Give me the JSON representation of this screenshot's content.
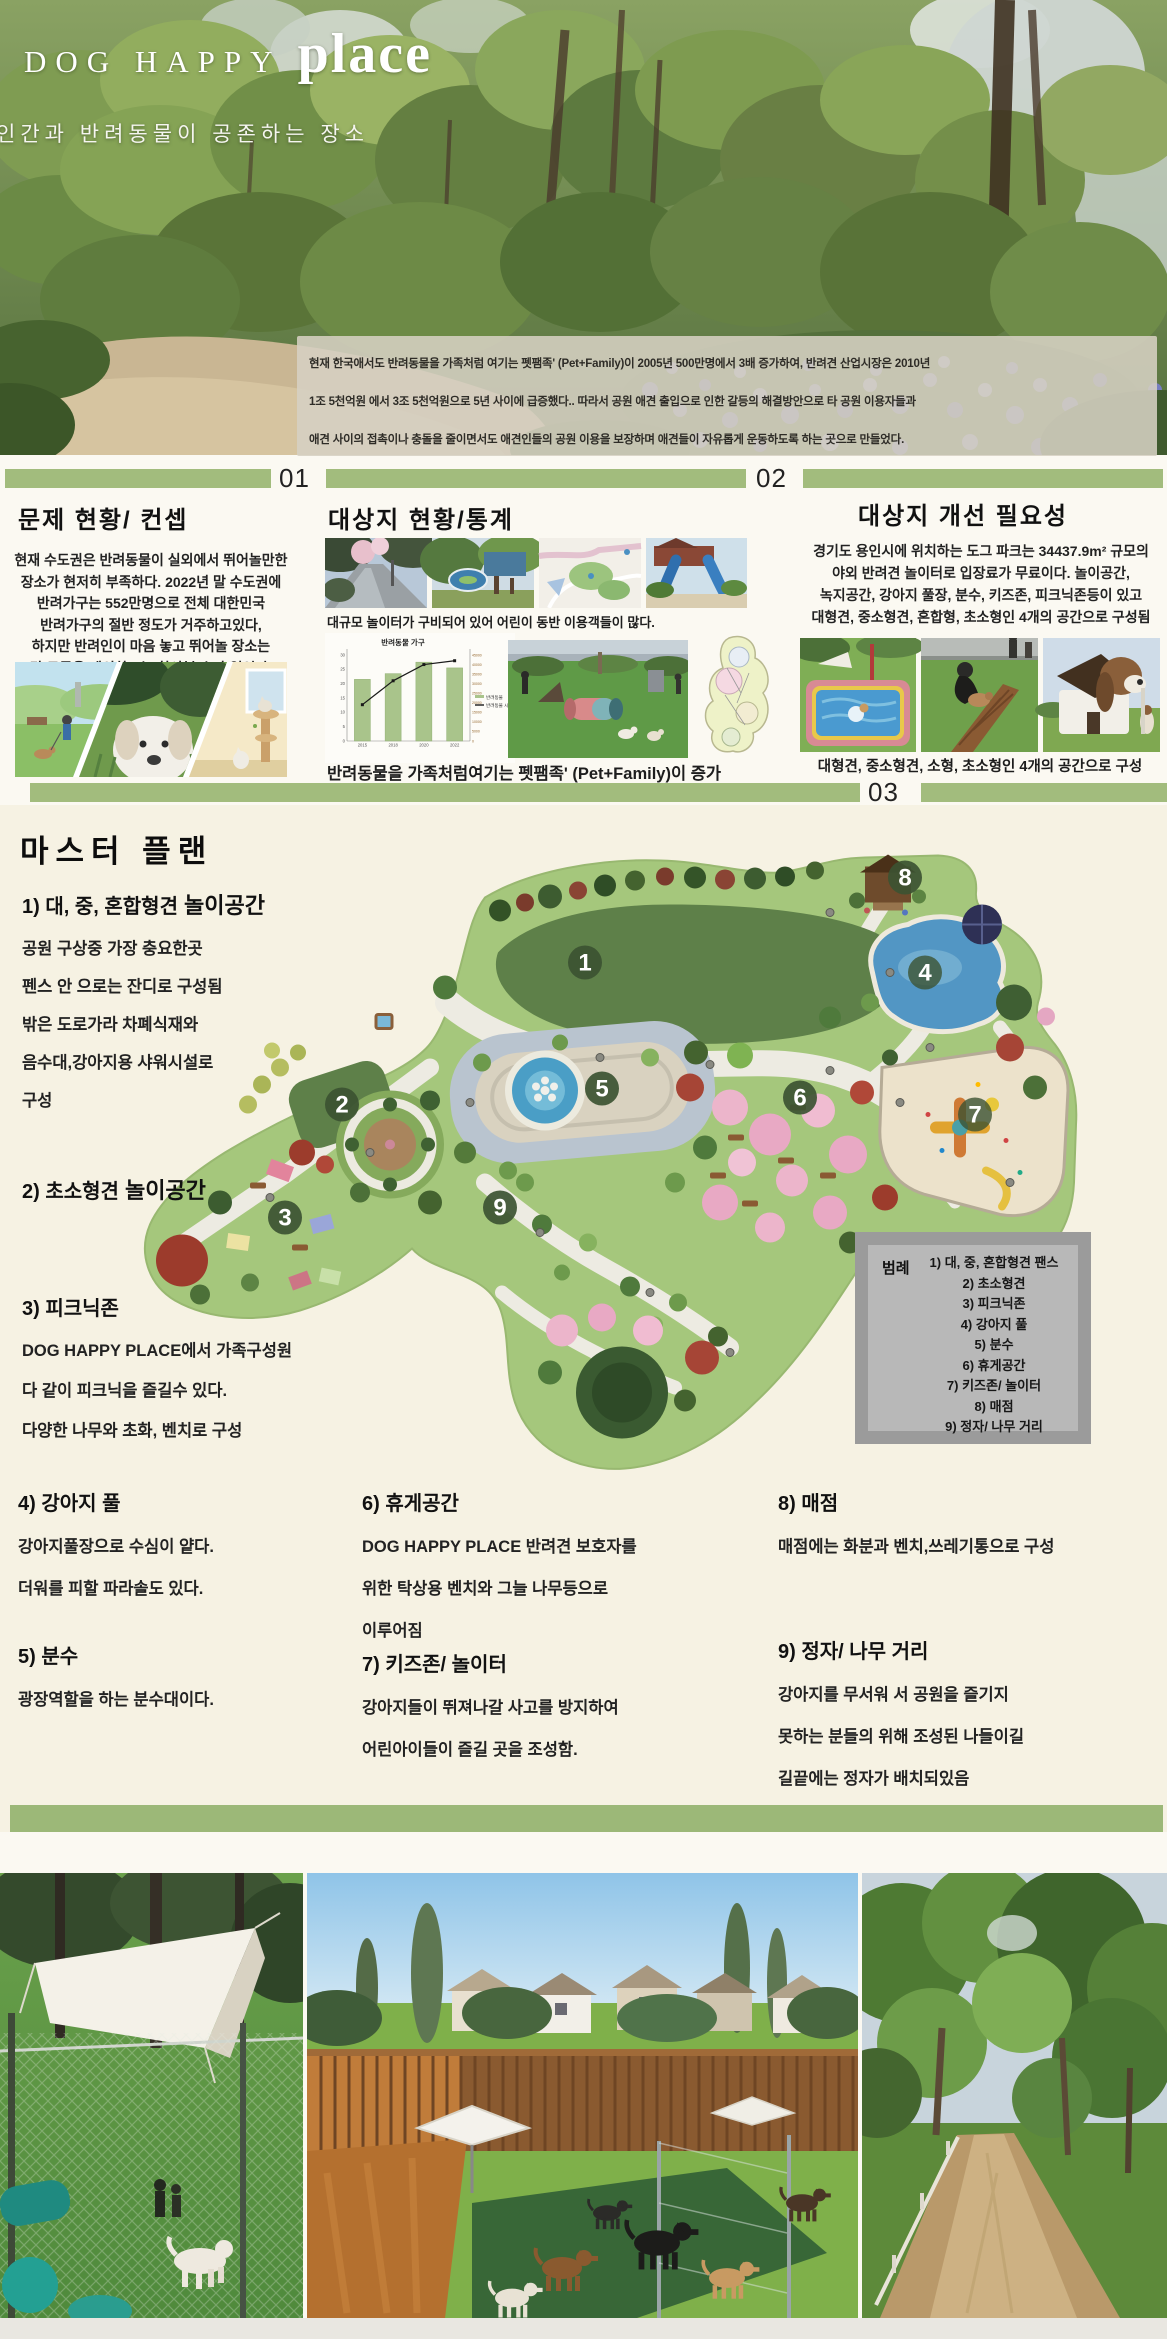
{
  "header": {
    "title_main": "DOG HAPPY",
    "title_accent": "place",
    "subtitle": "인간과 반려동물이 공존하는 장소",
    "intro": "현재 한국애서도 반려동물을 가족처럼 여기는 펫팸족' (Pet+Family)이 2005년 500만명에서 3배 증가하여, 반려견 산업시장은 2010년\n1조 5천억원 에서 3조 5천억원으로 5년 사이에 급증했다.. 따라서 공원 애견 출입으로 인한 갈등의 해결방안으로 타 공원 이용자들과\n애견 사이의 접촉이나 충돌을 줄이면서도 애견인들의 공원 이용을 보장하며 애견들이 자유롭게 운동하도록 하는 곳으로 만들었다."
  },
  "dividers": {
    "n1": "01",
    "n2": "02",
    "n3": "03"
  },
  "columns": {
    "problem": {
      "title": "문제 현황/ 컨셉",
      "body": "현재 수도권은 반려동물이 실외에서 뛰어놀만한\n장소가 현저히 부족하다. 2022년 말 수도권에\n반려가구는 552만명으로 전체 대한민국\n반려가구의 절반 정도가 거주하고있다,\n하지만 반려인이 마음 놓고 뛰어놀 장소는\n단 두곳을 제외하고는 찾아볼 수가 없었다."
    },
    "site": {
      "title": "대상지 현황/통계",
      "caption_top": "대규모 놀이터가 구비되어 있어 어린이 동반 이용객들이 많다.",
      "caption_bottom": "반려동물을 가족처럼여기는 펫팸족' (Pet+Family)이 증가"
    },
    "need": {
      "title": "대상지 개선 필요성",
      "body": "경기도 용인시에 위치하는 도그 파크는 34437.9m² 규모의\n야외 반려견 놀이터로 입장료가 무료이다. 놀이공간,\n녹지공간, 강아지 풀장, 분수, 키즈존, 피크닉존등이 있고\n대형견, 중소형견, 혼합형, 초소형인 4개의 공간으로 구성됨",
      "caption": "대형견, 중소형견, 소형, 초소형인 4개의 공간으로 구성"
    }
  },
  "chart_data": {
    "type": "bar+line",
    "title": "반려동물 가구",
    "categories": [
      "2015",
      "2018",
      "2020",
      "2022"
    ],
    "series": [
      {
        "name": "반려동물",
        "type": "bar",
        "axis": "left",
        "values": [
          21.5,
          23.5,
          27.5,
          25.5
        ]
      },
      {
        "name": "반려동물 시장",
        "type": "line",
        "axis": "right",
        "values": [
          19000,
          31500,
          40000,
          42000
        ]
      }
    ],
    "left_axis_max": 30,
    "left_axis_step": 5,
    "right_axis_max": 45000,
    "right_axis_step": 5000,
    "legend_position": "right",
    "bar_color": "#a9c48b",
    "line_color": "#1a1a1a"
  },
  "master": {
    "title": "마스터 플랜",
    "items": [
      {
        "heading": "1) 대, 중, 혼합형견",
        "heading_bold": "놀이공간",
        "body": "공원 구상중 가장 충요한곳\n펜스 안 으로는 잔디로 구성됨\n밖은 도로가라 차폐식재와\n음수대,강아지용 샤워시설로\n구성"
      },
      {
        "heading": "2) 초소형견",
        "heading_bold": "놀이공간",
        "body": ""
      },
      {
        "heading": "3) 피크닉존",
        "body": "DOG HAPPY PLACE에서 가족구성원\n다 같이 피크닉을 즐길수 있다.\n다양한 나무와 초화, 벤치로 구성"
      },
      {
        "heading": "4) 강아지 풀",
        "body": "강아지풀장으로 수심이 얕다.\n더워를 피할 파라솔도 있다."
      },
      {
        "heading": "5) 분수",
        "body": "광장역할을 하는 분수대이다."
      },
      {
        "heading": "6) 휴게공간",
        "body": "DOG HAPPY PLACE 반려견 보호자를\n위한 탁상용 벤치와 그늘 나무등으로\n이루어짐"
      },
      {
        "heading": "7) 키즈존/ 놀이터",
        "body": "강아지들이 뛰져나갈 사고를 방지하여\n어린아이들이 즐길 곳을 조성함."
      },
      {
        "heading": "8) 매점",
        "body": "매점에는 화분과 벤치,쓰레기통으로 구성"
      },
      {
        "heading": "9) 정자/ 나무 거리",
        "body": "강아지를 무서워 서 공원을 즐기지\n못하는 분들의 위해 조성된 나들이길\n길끝에는 정자가 배치되있음"
      }
    ],
    "legend": {
      "label": "범례",
      "items": [
        "1) 대, 중, 혼합형견 팬스",
        "2) 초소형견",
        "3) 피크닉존",
        "4) 강아지 풀",
        "5) 분수",
        "6) 휴게공간",
        "7) 키즈존/ 놀이터",
        "8) 매점",
        "9) 정자/ 나무 거리"
      ]
    },
    "markers": [
      "1",
      "2",
      "3",
      "4",
      "5",
      "6",
      "7",
      "8",
      "9"
    ]
  }
}
